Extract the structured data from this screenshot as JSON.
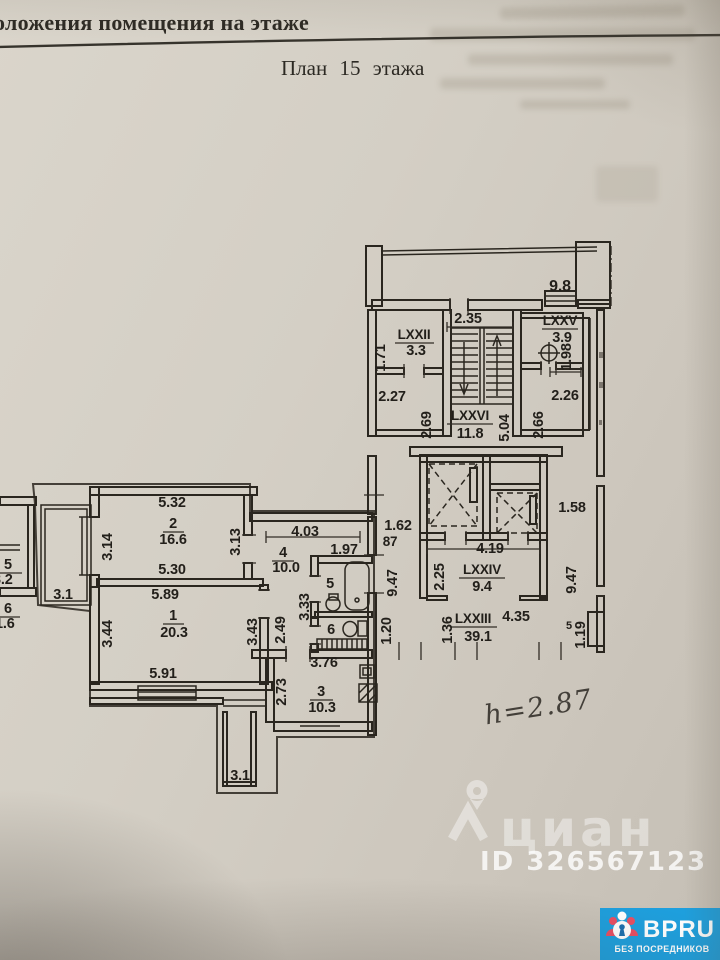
{
  "header": {
    "title_partial": "оложения помещения на этаже",
    "plan_title": "План 15 этажа"
  },
  "apartment": {
    "room_1": {
      "number": "1",
      "area": "20.3",
      "dim_top": "5.89",
      "dim_bottom": "5.91",
      "dim_left": "3.44",
      "dim_right": "3.43"
    },
    "room_2": {
      "number": "2",
      "area": "16.6",
      "dim_top": "5.32",
      "dim_bottom": "5.30",
      "dim_left": "3.14",
      "dim_right": "3.13"
    },
    "room_3_kitchen": {
      "number": "3",
      "area": "10.3",
      "dim_top": "3.76",
      "dim_left": "2.73"
    },
    "room_4_hall": {
      "number": "4",
      "area": "10.0",
      "dim_top": "4.03"
    },
    "room_5_bath": {
      "number": "5",
      "dim_top": "1.97",
      "dim_left": "3.33"
    },
    "room_6_wc": {
      "number": "6",
      "dim_left": "2.49"
    },
    "balcony_left": {
      "area": "3.1"
    },
    "balcony_bottom": {
      "area": "3.1"
    },
    "entry": {
      "niche_width": "1.62",
      "door_width": "87"
    }
  },
  "common_areas": {
    "roof_balcony": {
      "area": "9.8"
    },
    "lxxii": {
      "name": "LXXII",
      "area": "3.3",
      "dim_left": "1.71",
      "dim_below": "2.27"
    },
    "lxxv": {
      "name": "LXXV",
      "area": "3.9",
      "dim_right": "1.98",
      "dim_below": "2.26"
    },
    "stairs_lxxvi": {
      "name": "LXXVI",
      "area": "11.8",
      "dim_top": "2.35",
      "dim_right": "5.04",
      "dim_left": "2.69",
      "dim_far_right": "2.66"
    },
    "lift_lobby_lxxiv": {
      "name": "LXXIV",
      "area": "9.4",
      "dim_top": "4.19",
      "dim_left": "2.25",
      "dim_right": "1.58"
    },
    "corridor_lxxiii": {
      "name": "LXXIII",
      "area": "39.1",
      "dim_1": "4.35",
      "dim_2": "1.36",
      "dim_3": "1.20",
      "dim_4": "1.19",
      "dim_5": "5",
      "dim_left_height": "9.47",
      "dim_right_height": "9.47"
    }
  },
  "neighbor_labels": {
    "room_5": {
      "number": "5",
      "area": "3.2"
    },
    "room_6": {
      "number": "6",
      "area": "1.6"
    }
  },
  "handwriting": {
    "ceiling_height": "h=2.87"
  },
  "watermark": {
    "brand": "циан",
    "listing_id": "ID 326567123"
  },
  "badge": {
    "brand": "BPRU",
    "tagline": "БЕЗ ПОСРЕДНИКОВ"
  },
  "colors": {
    "badge_blue": "#1e9fdd",
    "red_outline": "#b0453c",
    "figure_red": "#e84f63",
    "keyhole_blue": "#1b6fae"
  }
}
